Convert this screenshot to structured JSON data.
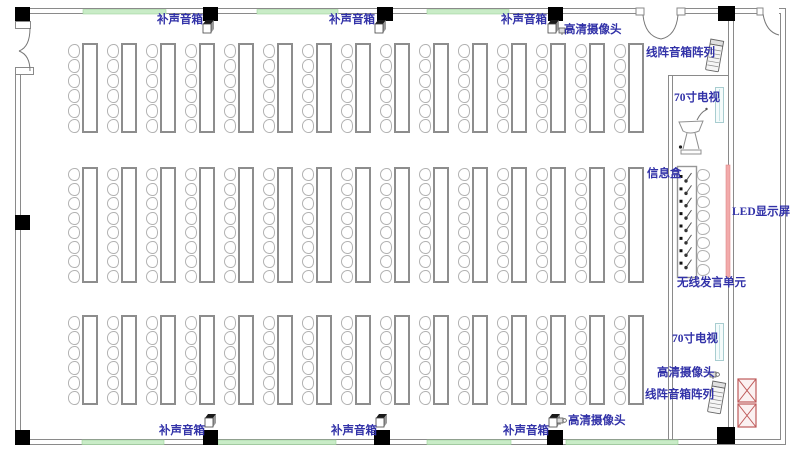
{
  "labels": {
    "fill_speaker": "补声音箱",
    "hd_camera": "高清摄像头",
    "line_array": "线阵音箱阵列",
    "tv70": "70寸电视",
    "info_box": "信息盒",
    "led_screen": "LED显示屏",
    "wireless_unit": "无线发言单元"
  },
  "colors": {
    "label_text": "#3232a8",
    "wall_line": "#8a8a8a",
    "green_strip": "#c9ecc7",
    "led_strip": "#f2abab",
    "tv_outline": "#a8cdd0",
    "column_fill": "#000000",
    "rack_red": "#bf5a5a"
  },
  "seating": {
    "columns": 15,
    "unit_step": 39,
    "first_chair_x": 68,
    "chair_w": 12,
    "table_w": 16,
    "table_gap": 14,
    "rows": [
      {
        "y": 43,
        "height": 90,
        "chairs_per_table": 6
      },
      {
        "y": 167,
        "height": 116,
        "chairs_per_table": 8
      },
      {
        "y": 315,
        "height": 90,
        "chairs_per_table": 6
      }
    ],
    "head_table": {
      "x": 677,
      "y": 166,
      "w": 19,
      "h": 111,
      "units": 8,
      "chairs": 8,
      "chair_x": 697,
      "chair_y": 169,
      "chair_area_h": 108
    }
  }
}
